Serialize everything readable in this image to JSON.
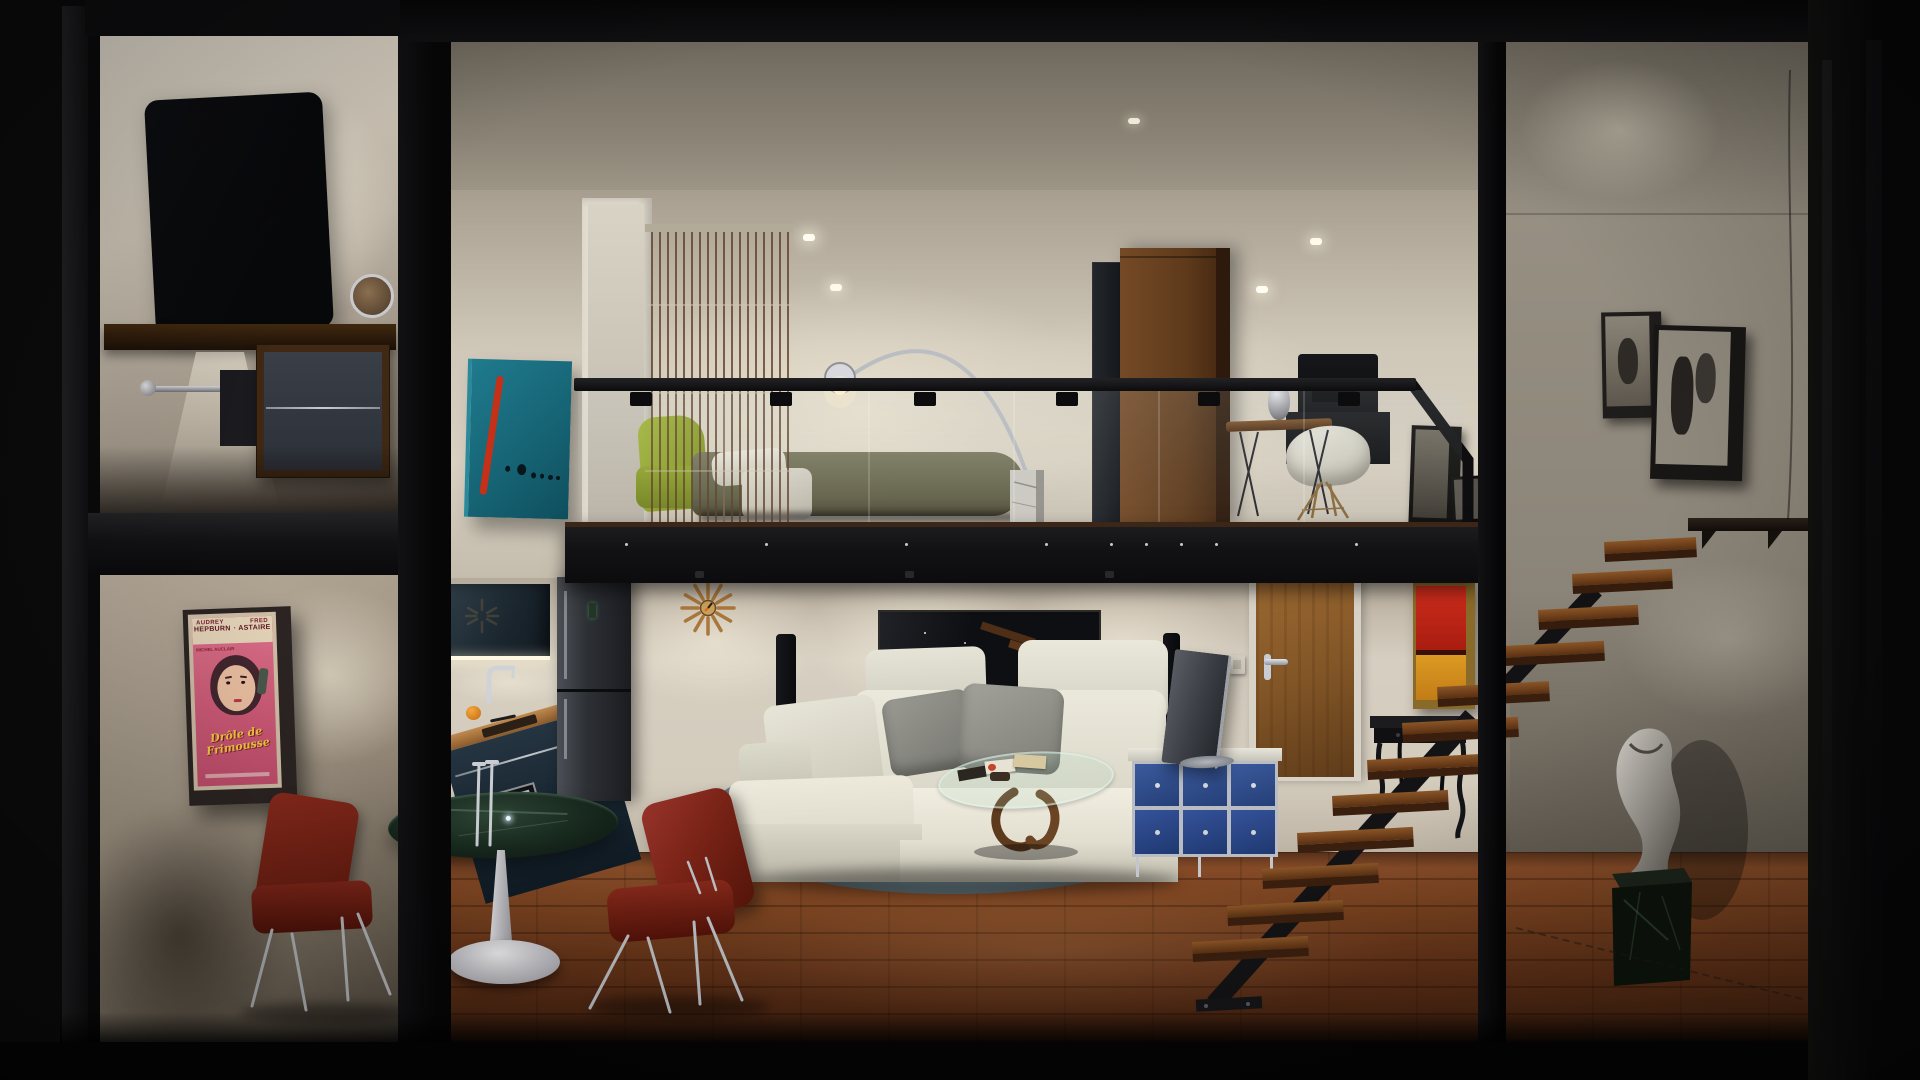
{
  "scene": {
    "title": "Night interior render — two-story loft cross-section",
    "areas": "mezzanine bedroom and office above; kitchen, dining, living room, floating staircase and gallery hall below"
  },
  "poster": {
    "name1a": "AUDREY",
    "name1b": "FRED",
    "name2a": "HEPBURN",
    "name2b": "· ASTAIRE",
    "credit": "MICHEL AUCLAIR",
    "title1": "Drôle de",
    "title2": "Frimousse"
  },
  "palette": {
    "frame_black": "#0b0b0d",
    "warm_wall": "#cfc8ba",
    "concrete": "#8b857a",
    "wood_floor": "#6b3a1e",
    "kitchen_teal": "#26333c",
    "sofa_cream": "#e9e7da",
    "rug_blue_gray": "#9fb4ba",
    "chair_red": "#7c2216",
    "sideboard_blue": "#33518f",
    "painting_teal": "#1a6e80",
    "painting_red": "#c22418",
    "painting_orange": "#d8951f",
    "poster_pink": "#d4607e",
    "poster_yellow": "#f2cb3d",
    "bed_olive": "#6b6950",
    "chaise_chartreuse": "#8fa32c",
    "clock_bronze": "#a9773b"
  }
}
